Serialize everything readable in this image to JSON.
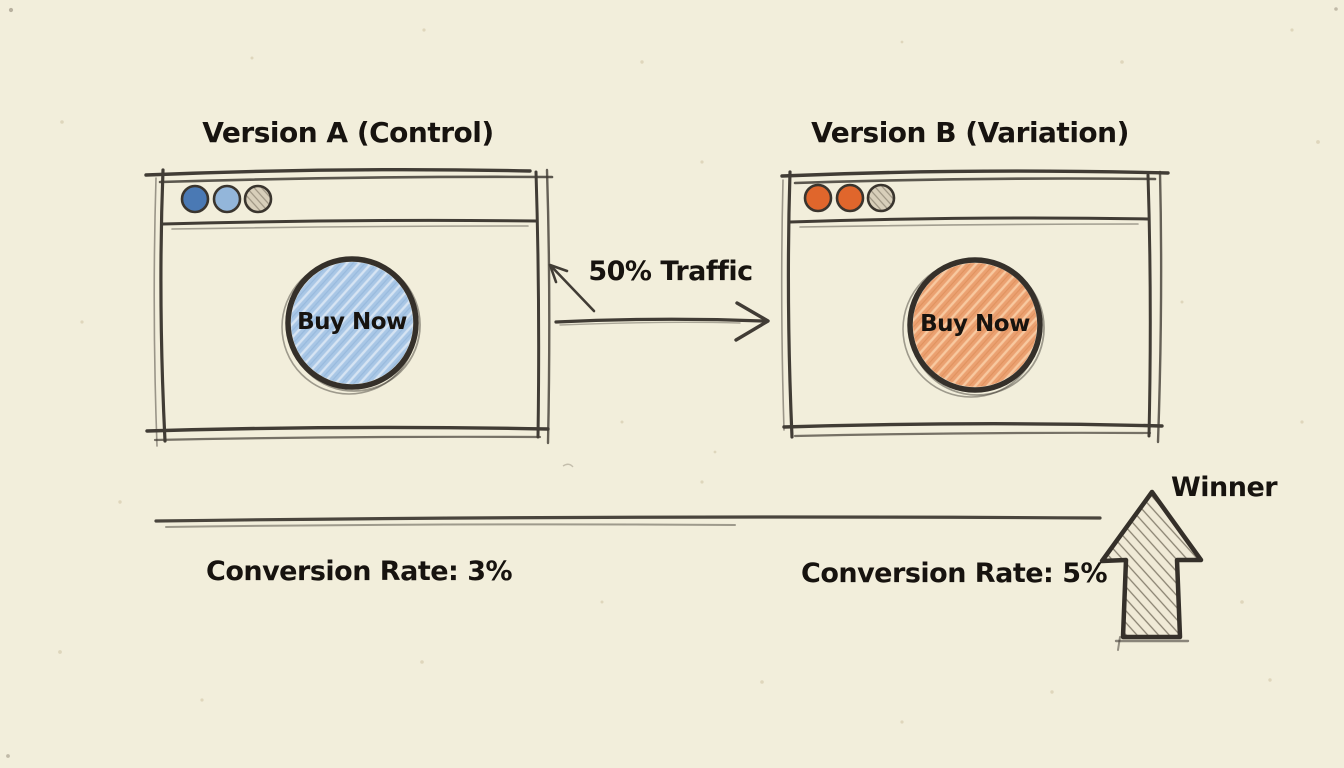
{
  "diagram": {
    "description": "Hand-drawn A/B testing comparison sketch",
    "background_color": "#f2eedb",
    "ink_color": "#413c35",
    "text_color": "#17130f"
  },
  "version_a": {
    "title": "Version A (Control)",
    "button_label": "Buy Now",
    "button_fill": "#a9c7e6",
    "window_dot_colors": [
      "#4a79b4",
      "#93b6da",
      "#d8cfba"
    ],
    "conversion_label": "Conversion Rate: 3%",
    "conversion_rate": "3%"
  },
  "version_b": {
    "title": "Version B (Variation)",
    "button_label": "Buy Now",
    "button_fill": "#eba171",
    "window_dot_colors": [
      "#e0662c",
      "#e0662c",
      "#d8cfba"
    ],
    "conversion_label": "Conversion Rate: 5%",
    "conversion_rate": "5%"
  },
  "traffic_split": {
    "label": "50% Traffic"
  },
  "winner": {
    "label": "Winner",
    "points_to": "Version B"
  }
}
